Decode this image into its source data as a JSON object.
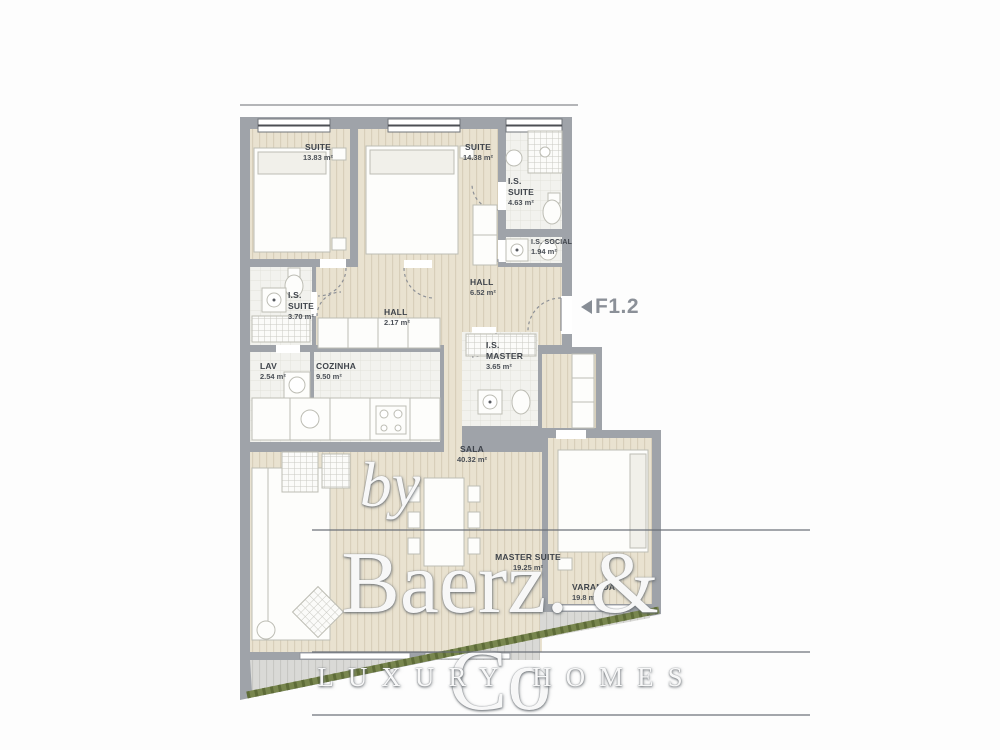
{
  "plan": {
    "unit_label": "F1.2"
  },
  "watermark": {
    "prefix": "by",
    "brand": "Baerz. & Co",
    "tagline": "LUXURY HOMES"
  },
  "rooms": [
    {
      "id": "suite-1",
      "name": "SUITE",
      "area": "13.83 m²"
    },
    {
      "id": "suite-2",
      "name": "SUITE",
      "area": "14.38 m²"
    },
    {
      "id": "is-suite-right",
      "name": "I.S. SUITE",
      "area": "4.63 m²"
    },
    {
      "id": "is-social",
      "name": "I.S. SOCIAL",
      "area": "1.94 m²"
    },
    {
      "id": "hall",
      "name": "HALL",
      "area": "6.52 m²"
    },
    {
      "id": "is-suite-left",
      "name": "I.S. SUITE",
      "area": "3.70 m²"
    },
    {
      "id": "hall-2",
      "name": "HALL",
      "area": "2.17 m²"
    },
    {
      "id": "lav",
      "name": "LAV",
      "area": "2.54 m²"
    },
    {
      "id": "cozinha",
      "name": "COZINHA",
      "area": "9.50 m²"
    },
    {
      "id": "is-master",
      "name": "I.S. MASTER",
      "area": "3.65 m²"
    },
    {
      "id": "sala",
      "name": "SALA",
      "area": "40.32 m²"
    },
    {
      "id": "master-suite",
      "name": "MASTER SUITE",
      "area": "19.25 m²"
    },
    {
      "id": "varanda",
      "name": "VARANDA",
      "area": "19.8 m²"
    }
  ],
  "colors": {
    "wall": "#9fa3a9",
    "wood_floor": "#e9e2d0",
    "tile_floor": "#f2f2ee",
    "deck": "#d9d9d6",
    "hedge": "#78864e",
    "label_text": "#3f444b",
    "marker_text": "#8b9098"
  }
}
